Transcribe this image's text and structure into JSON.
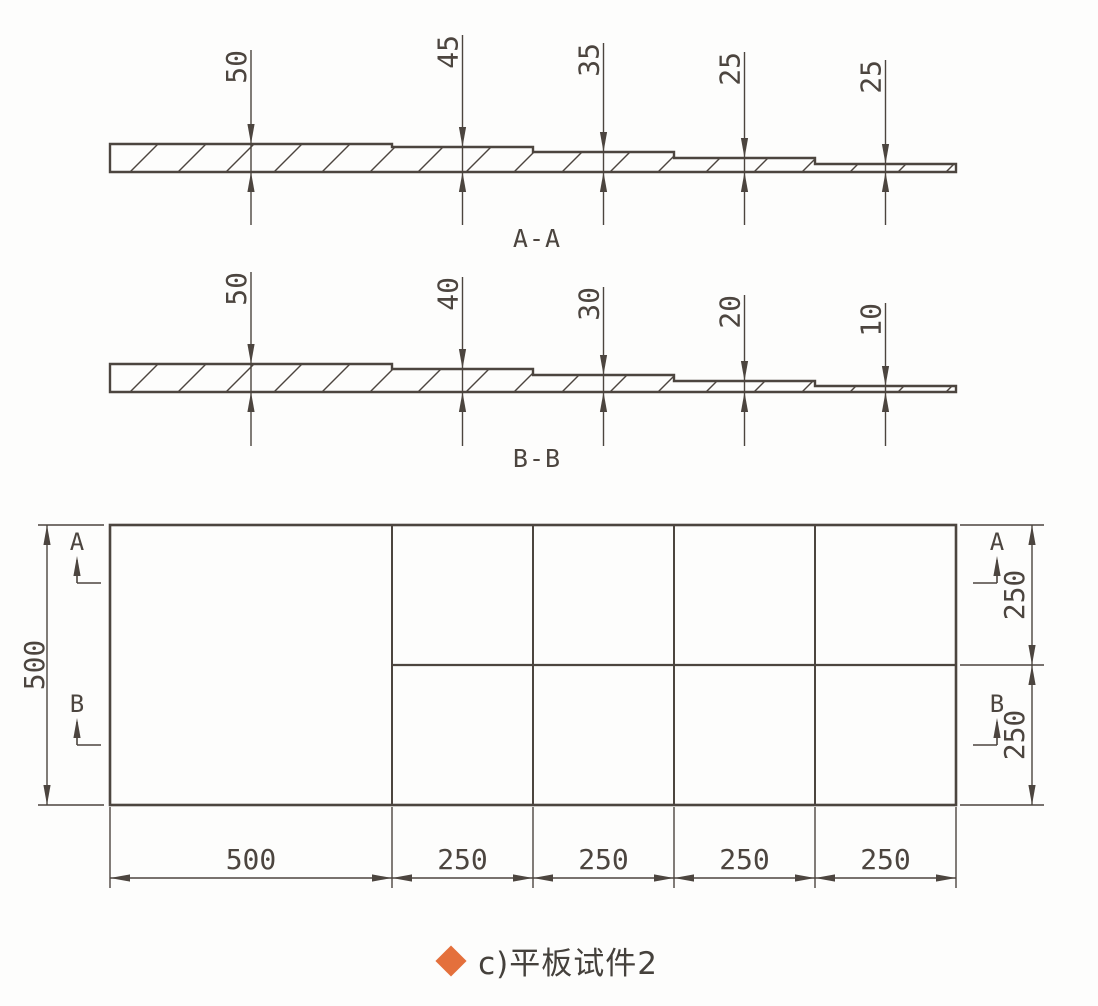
{
  "palette": {
    "line": "#4c453f",
    "text": "#4c453f",
    "background": "#fdfdfc",
    "bullet": "#e4703c"
  },
  "sections": [
    {
      "title": "A-A",
      "dim_labels": [
        "50",
        "45",
        "35",
        "25",
        "25"
      ],
      "thickness_values": [
        50,
        45,
        35,
        25,
        25
      ],
      "geometry": {
        "bottom_y": 172,
        "draw_px": [
          28,
          25,
          20,
          14,
          8
        ],
        "label_top": [
          50,
          35,
          43,
          52,
          60
        ],
        "lower_end": 225,
        "title_y": 247
      }
    },
    {
      "title": "B-B",
      "dim_labels": [
        "50",
        "40",
        "30",
        "20",
        "10"
      ],
      "thickness_values": [
        50,
        40,
        30,
        20,
        10
      ],
      "geometry": {
        "bottom_y": 392,
        "draw_px": [
          28,
          23,
          17,
          11,
          6
        ],
        "label_top": [
          272,
          277,
          287,
          295,
          303
        ],
        "lower_end": 446,
        "title_y": 467
      }
    }
  ],
  "plan": {
    "bottom_dim_labels": [
      "500",
      "250",
      "250",
      "250",
      "250"
    ],
    "left_dim_label": "500",
    "right_dim_labels": [
      "250",
      "250"
    ],
    "markers_left": [
      "A",
      "B"
    ],
    "markers_right": [
      "A",
      "B"
    ],
    "geometry": {
      "x_bounds": [
        110,
        392,
        533,
        674,
        815,
        956
      ],
      "y_top": 525,
      "y_mid": 665,
      "y_bottom": 805,
      "left_ext_x": [
        38,
        104
      ],
      "left_dim_x": 47,
      "right_ext_x": [
        960,
        1044
      ],
      "right_dim_x": 1032,
      "bottom_dim_y": 878,
      "bottom_ext_end": 888,
      "bottom_label_y": 869,
      "marker_left_x": 77,
      "marker_right_x": 997,
      "marker_letter_y": [
        550,
        712
      ],
      "marker_arrow_top": [
        556,
        718
      ],
      "marker_arrow_base": [
        583,
        745
      ],
      "marker_h_len": 24
    }
  },
  "layout": {
    "title_x": 537,
    "hatch_step": 48,
    "canvas": [
      1098,
      1006
    ]
  },
  "caption": {
    "bullet_icon": "diamond",
    "text": "c)平板试件2"
  }
}
